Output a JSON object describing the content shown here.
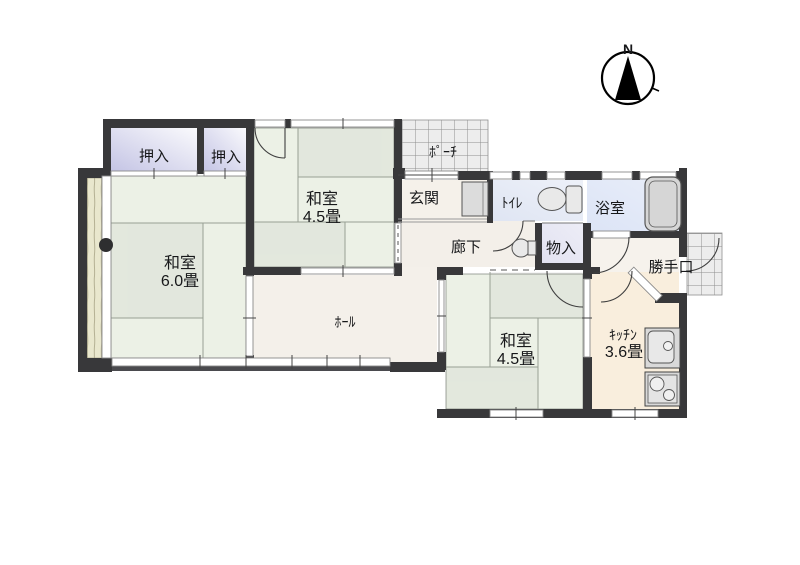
{
  "meta": {
    "type": "floor-plan",
    "description": "Japanese single-storey house floor plan"
  },
  "compass": {
    "label": "N"
  },
  "colors": {
    "wall": "#38383a",
    "window_line": "#8a8a8a",
    "tatami_line": "#98a094",
    "tile_line": "#8f8f8f",
    "tile_fill": "#ededed",
    "arc": "#3f3f3f",
    "fixture_fill": "#dcdcdc",
    "fixture_stroke": "#555555"
  },
  "rooms": {
    "oshiire_left": {
      "label": "押入",
      "floor_color": "#cfcfea"
    },
    "oshiire_right": {
      "label": "押入",
      "floor_color": "#cfcfea"
    },
    "washitsu_top": {
      "label": "和室",
      "size": "4.5畳",
      "floor_color": "#ecf1e6"
    },
    "washitsu_left": {
      "label": "和室",
      "size": "6.0畳",
      "floor_color": "#ecf1e6"
    },
    "washitsu_bottom": {
      "label": "和室",
      "size": "4.5畳",
      "floor_color": "#ecf1e6"
    },
    "hall": {
      "label": "ﾎｰﾙ",
      "floor_color": "#f4f0ea"
    },
    "genkan": {
      "label": "玄関",
      "floor_color": "#f5f1ea"
    },
    "porch": {
      "label": "ﾎﾟｰﾁ",
      "floor_color": "#ededed"
    },
    "rouka": {
      "label": "廊下",
      "floor_color": "#f3efe9"
    },
    "toilet": {
      "label": "ﾄｲﾚ",
      "floor_color": "#dfe5f3"
    },
    "bath": {
      "label": "浴室",
      "floor_color": "#dce4f6"
    },
    "mono_ire": {
      "label": "物入",
      "floor_color": "#e2e2f1"
    },
    "katteguchi": {
      "label": "勝手口",
      "floor_color": "#f6f2ec"
    },
    "kitchen": {
      "label": "ｷｯﾁﾝ",
      "size": "3.6畳",
      "floor_color": "#f9eedd"
    },
    "veranda": {
      "floor_color": "#e9e7cd"
    }
  }
}
